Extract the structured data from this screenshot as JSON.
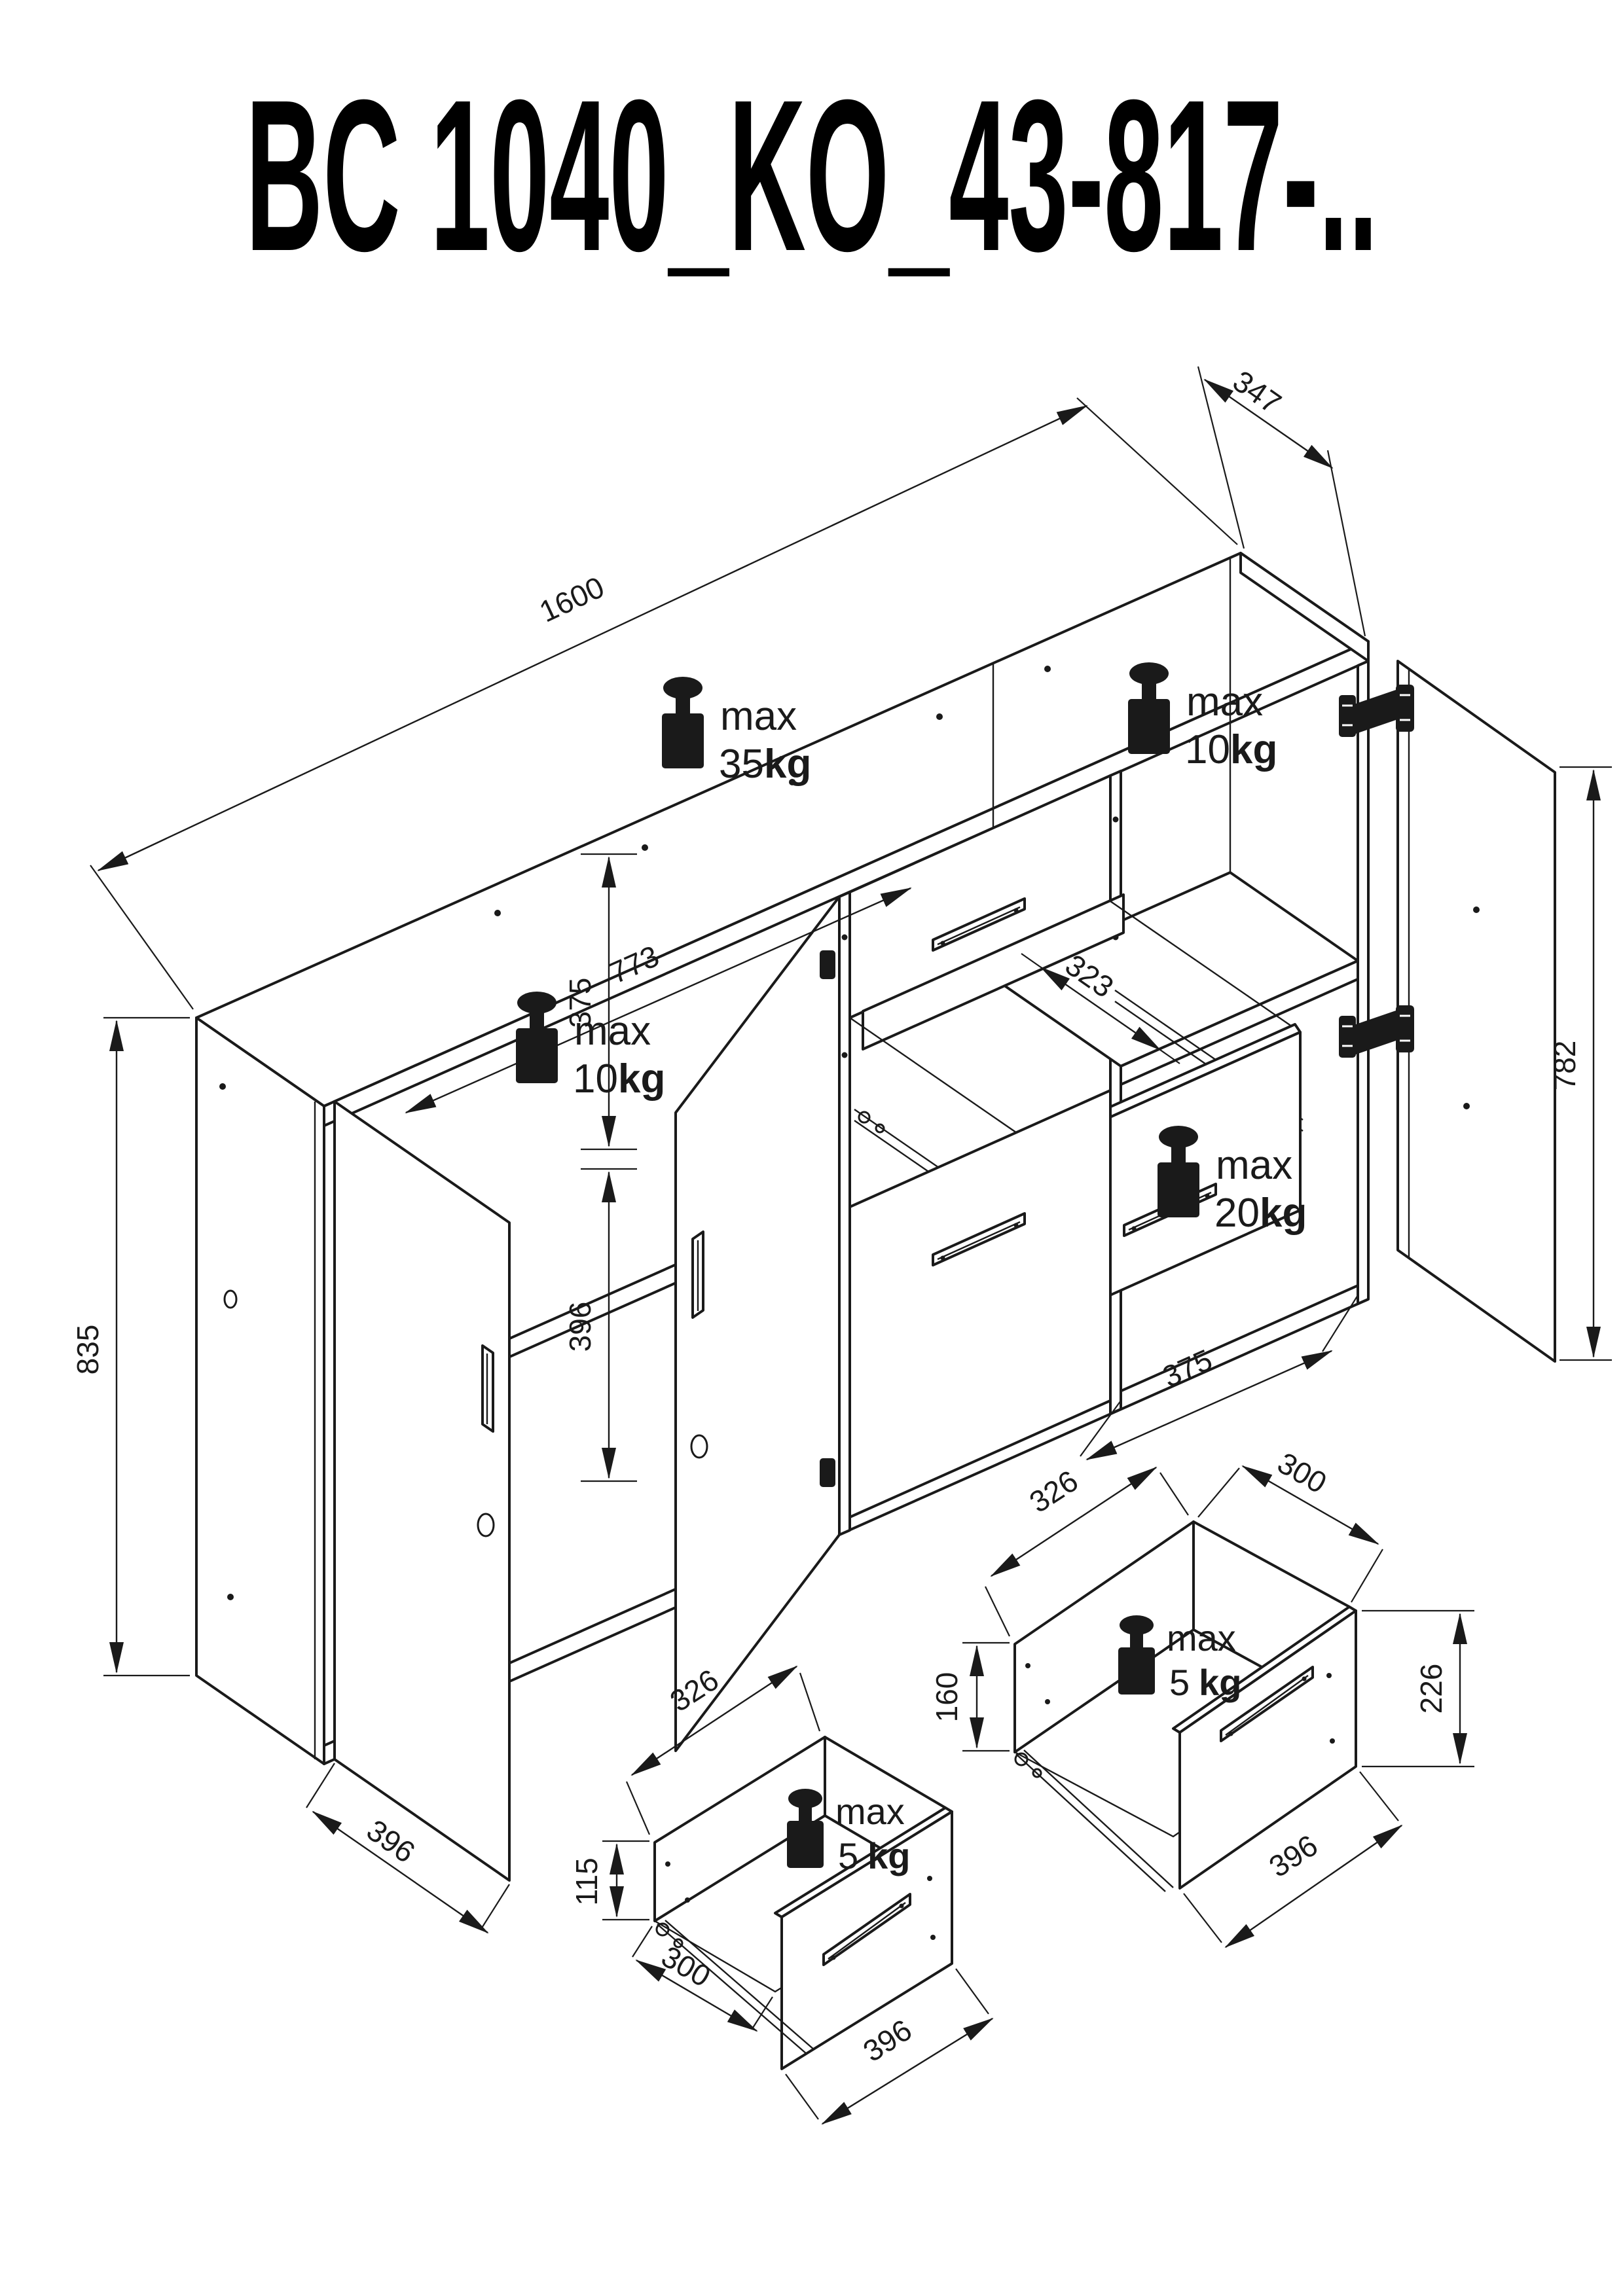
{
  "title": "BC 1040_KO_43-817-..",
  "colors": {
    "ink": "#1a1a1a",
    "paper": "#ffffff"
  },
  "main_view": {
    "description": "isometric technical drawing of a three-door two-drawer sideboard",
    "dims": {
      "width": "1600",
      "depth": "347",
      "height": "835",
      "left_door_width": "396",
      "left_inner_width": "773",
      "upper_inner_height": "375",
      "lower_inner_height": "396",
      "right_shelf_depth": "323",
      "right_inner_width": "375",
      "right_door_height": "782"
    },
    "loads": {
      "top": {
        "label": "max",
        "value": "35",
        "unit": "kg"
      },
      "right_shelf": {
        "label": "max",
        "value": "10",
        "unit": "kg"
      },
      "left_shelf": {
        "label": "max",
        "value": "10",
        "unit": "kg"
      },
      "bottom_right": {
        "label": "max",
        "value": "20",
        "unit": "kg"
      }
    }
  },
  "drawer_detail_upper": {
    "description": "detail of upper small drawer",
    "dims": {
      "depth": "326",
      "inner_width": "300",
      "side_height": "160",
      "front_height": "226",
      "front_width": "396"
    },
    "load": {
      "label": "max",
      "value": "5",
      "unit": "kg"
    }
  },
  "drawer_detail_lower": {
    "description": "detail of lower small drawer",
    "dims": {
      "depth": "326",
      "side_height": "115",
      "inner_width": "300",
      "front_width": "396"
    },
    "load": {
      "label": "max",
      "value": "5",
      "unit": "kg"
    }
  }
}
